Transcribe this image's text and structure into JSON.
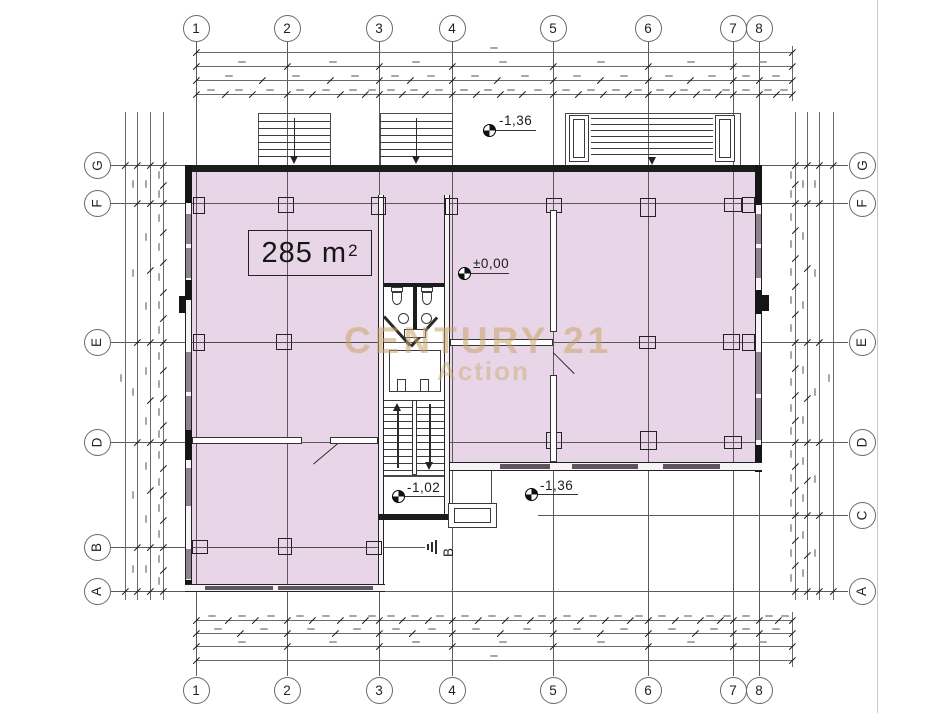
{
  "drawing": {
    "area_label": {
      "value": "285",
      "unit": "m",
      "sup": "2"
    },
    "elevation_markers": [
      {
        "id": "upper-entry",
        "value": "-1,36"
      },
      {
        "id": "ground-floor",
        "value": "±0,00"
      },
      {
        "id": "stair-landing",
        "value": "-1,02"
      },
      {
        "id": "lower-entry",
        "value": "-1,36"
      }
    ],
    "section_marker": "B",
    "grid": {
      "columns": [
        "1",
        "2",
        "3",
        "4",
        "5",
        "6",
        "7",
        "8"
      ],
      "rows_left": [
        "G",
        "F",
        "E",
        "D",
        "B",
        "A"
      ],
      "rows_right": [
        "G",
        "F",
        "E",
        "D",
        "C",
        "A"
      ]
    },
    "watermark": {
      "line1": "CENTURY 21",
      "line2": "Action",
      "color": "#c8a46a"
    },
    "colors": {
      "floor_fill": "#e8d5e7",
      "wall": "#1c1c1c",
      "grid_line": "#5a5a5a"
    }
  }
}
